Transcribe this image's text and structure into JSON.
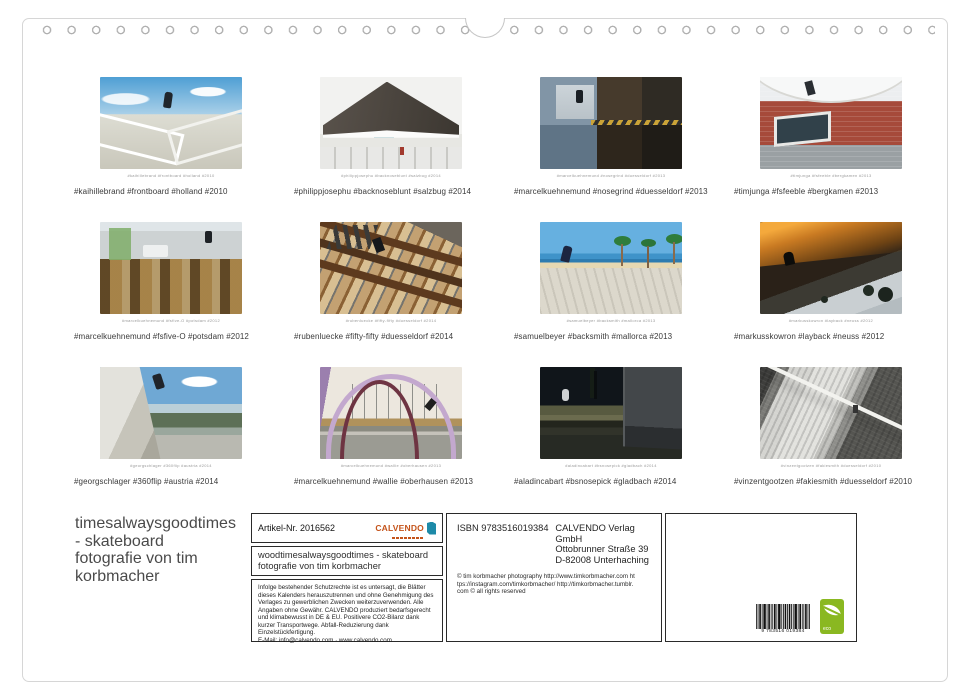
{
  "grid": {
    "photos": [
      {
        "caption": "#kaihillebrand #frontboard #holland #2010",
        "alt": "skater frontboard on white pier railing at the beach"
      },
      {
        "caption": "#philippjosephu #backnoseblunt #salzbug #2014",
        "alt": "back noseblunt at modern building with angular dark roof"
      },
      {
        "caption": "#marcelkuehnemund #nosegrind #duesseldorf #2013",
        "alt": "nosegrind on ledge mirrored in puddle reflection"
      },
      {
        "caption": "#timjunga #fsfeeble #bergkamen #2013",
        "alt": "fs feeble fisheye shot on brick building window ledge"
      },
      {
        "caption": "#marcelkuehnemund #fsfive-O #potsdam #2012",
        "alt": "fs five-0 on rail behind flea market picture frames"
      },
      {
        "caption": "#rubenluecke #fifty-fifty #duesseldorf #2014",
        "alt": "fifty-fifty on wooden indoor staircase railing"
      },
      {
        "caption": "#samuelbeyer #backsmith #mallorca #2013",
        "alt": "back smith at beach promenade with palm trees"
      },
      {
        "caption": "#markusskowron #layback #neuss #2012",
        "alt": "layback silhouette on bank at sunset"
      },
      {
        "caption": "#georgschlager #360flip #austria #2014",
        "alt": "360 flip over rocks by a river"
      },
      {
        "caption": "#marcelkuehnemund #wallie #oberhausen #2013",
        "alt": "wallie on pink arch bridge"
      },
      {
        "caption": "#aladincabart #bsnosepick #gladbach #2014",
        "alt": "bs nosepick on mossy wall at night"
      },
      {
        "caption": "#vinzentgootzen #fakiesmith #duesseldorf #2010",
        "alt": "fakie smith on concrete bank, black and white"
      }
    ]
  },
  "footer": {
    "title_lines": [
      "timesalwaysgoodtimes",
      "- skateboard",
      "fotografie von tim",
      "korbmacher"
    ],
    "artikel_label": "Artikel-Nr. 2016562",
    "brand": "CALVENDO",
    "product_title": "woodtimesalwaysgoodtimes - skateboard fotografie von tim korbmacher",
    "legal": "Infolge bestehender Schutzrechte ist es untersagt, die Blätter dieses Kalenders herauszutrennen und ohne Genehmigung des Verlages zu gewerblichen Zwecken weiterzuverwenden. Alle Angaben ohne Gewähr. CALVENDO produziert bedarfsgerecht und klimabewusst in DE & EU. Positivere CO2-Bilanz dank kurzer Transportwege. Abfall-Reduzierung dank Einzelstückfertigung.",
    "email_line": "E-Mail: info@calvendo.com · www.calvendo.com",
    "isbn": "ISBN 9783516019384",
    "publisher_lines": [
      "CALVENDO Verlag GmbH",
      "Ottobrunner Straße 39",
      "D-82008 Unterhaching"
    ],
    "credits": "© tim korbmacher photography http://www.timkorbmacher.com https://instagram.com/timkorbmacher/ http://timkorbmacher.tumblr.com © all rights reserved",
    "barcode_digits": "9 783516 019384",
    "eco_label": "eco"
  },
  "colors": {
    "accent_orange": "#c4531a",
    "accent_teal": "#1d8aa8",
    "eco_green": "#8ab821"
  }
}
